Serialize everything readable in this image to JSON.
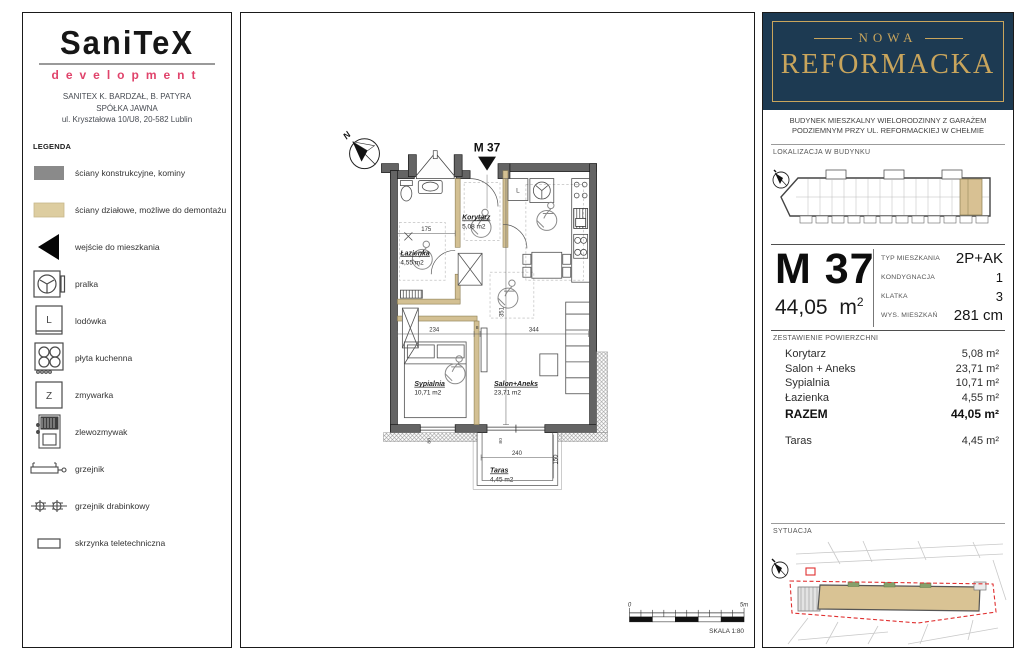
{
  "colors": {
    "brand_navy": "#1d3a52",
    "brand_gold": "#c9a55c",
    "accent_pink": "#e0436b",
    "wall_structural_gray": "#646464",
    "wall_partition_beige": "#d3c093",
    "site_boundary_red": "#e03030"
  },
  "left_panel": {
    "logo": "SaniTeX",
    "logo_sub": "development",
    "company_line1": "SANITEX K. BARDZAŁ, B. PATYRA",
    "company_line2": "SPÓŁKA JAWNA",
    "company_line3": "ul. Kryształowa 10/U8, 20-582 Lublin",
    "legend_title": "LEGENDA",
    "legend_items": [
      {
        "icon": "wall-structural-swatch",
        "label": "ściany konstrukcyjne, kominy"
      },
      {
        "icon": "wall-partition-swatch",
        "label": "ściany działowe, możliwe do demontażu"
      },
      {
        "icon": "entrance-arrow",
        "label": "wejście do mieszkania"
      },
      {
        "icon": "washing-machine",
        "label": "pralka"
      },
      {
        "icon": "fridge",
        "label": "lodówka",
        "glyph": "L"
      },
      {
        "icon": "cooktop",
        "label": "płyta kuchenna"
      },
      {
        "icon": "dishwasher",
        "label": "zmywarka",
        "glyph": "Z"
      },
      {
        "icon": "kitchen-sink",
        "label": "zlewozmywak"
      },
      {
        "icon": "radiator",
        "label": "grzejnik"
      },
      {
        "icon": "ladder-radiator",
        "label": "grzejnik drabinkowy"
      },
      {
        "icon": "telecom-box",
        "label": "skrzynka teletechniczna"
      }
    ]
  },
  "plan": {
    "north_label": "N",
    "unit_label": "M 37",
    "fridge_label": "L",
    "rooms": [
      {
        "name": "Korytarz",
        "area": "5,08 m2"
      },
      {
        "name": "Łazienka",
        "area": "4,55 m2"
      },
      {
        "name": "Sypialnia",
        "area": "10,71 m2"
      },
      {
        "name": "Salon+Aneks",
        "area": "23,71 m2"
      },
      {
        "name": "Taras",
        "area": "4,45 m2"
      }
    ],
    "dims": {
      "bedroom_w": "234",
      "wall": "8",
      "salon_w": "344",
      "depth": "351",
      "bath_w": "175",
      "taras_w": "240",
      "taras_d": "150",
      "win_a": "80",
      "win_b": "80"
    },
    "scale": {
      "zero": "0",
      "max": "5m",
      "label": "SKALA 1:80"
    }
  },
  "right_panel": {
    "brand_top": "NOWA",
    "brand_main": "REFORMACKA",
    "building_desc1": "BUDYNEK MIESZKALNY WIELORODZINNY Z GARAŻEM",
    "building_desc2": "PODZIEMNYM PRZY UL. REFORMACKIEJ W CHEŁMIE",
    "location_title": "LOKALIZACJA W BUDYNKU",
    "unit_code": "M 37",
    "unit_area": "44,05",
    "unit_area_unit": "m",
    "unit_area_sup": "2",
    "specs": [
      {
        "label": "TYP MIESZKANIA",
        "value": "2P+AK"
      },
      {
        "label": "KONDYGNACJA",
        "value": "1"
      },
      {
        "label": "KLATKA",
        "value": "3"
      },
      {
        "label": "WYS. MIESZKAŃ",
        "value": "281 cm"
      }
    ],
    "areas_title": "ZESTAWIENIE POWIERZCHNI",
    "areas": [
      {
        "label": "Korytarz",
        "value": "5,08 m²"
      },
      {
        "label": "Salon + Aneks",
        "value": "23,71 m²"
      },
      {
        "label": "Sypialnia",
        "value": "10,71 m²"
      },
      {
        "label": "Łazienka",
        "value": "4,55 m²"
      }
    ],
    "total_label": "RAZEM",
    "total_value": "44,05 m²",
    "terrace_label": "Taras",
    "terrace_value": "4,45 m²",
    "situation_title": "SYTUACJA"
  }
}
